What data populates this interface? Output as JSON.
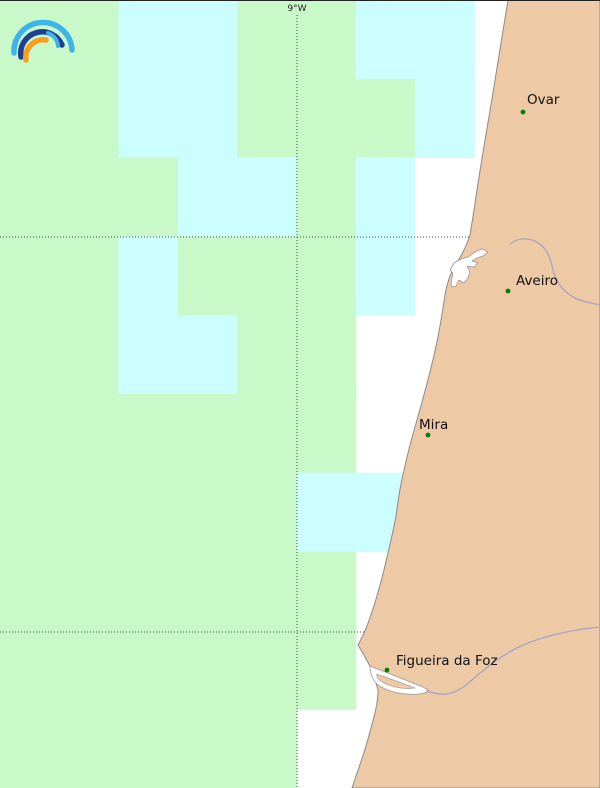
{
  "map": {
    "title": "coastal-forecast-map",
    "colors": {
      "sea": "#ffffff",
      "cell_green": "#c9f8c9",
      "cell_cyan": "#ccfdff",
      "land": "#edc9a6",
      "coast_stroke": "#8c8c8c",
      "water_outline": "#9a9a9a",
      "river": "#a9a3c4",
      "grid_line": "#4d4d4d",
      "city_dot": "#0a7a0a",
      "label_text": "#111111",
      "top_border": "#222222"
    },
    "grid": {
      "cols": 10,
      "rows": 10,
      "cell_w": 59.3,
      "cell_h": 78.8,
      "legend": "G=green cell, C=cyan cell, W=no cell",
      "cells": [
        "GGCCGGCCWW",
        "GGCCGGGCWW",
        "GGGCCGCWWW",
        "GGCGGGCWWW",
        "GGCCGGWWWW",
        "GGGGGGWWWW",
        "GGGGGCCWWW",
        "GGGGGGWWWW",
        "GGGGGGWWWW",
        "GGGGGWWWWW"
      ]
    },
    "graticule": {
      "meridian_label": "9°W",
      "meridian_x": 297,
      "meridian_label_x": 297,
      "meridian_label_y": 11,
      "meridian_y1": 15,
      "meridian_y2": 788,
      "parallels_y": [
        237,
        632
      ]
    },
    "cities": [
      {
        "name": "Ovar",
        "dot": [
          523,
          112
        ],
        "label": [
          527,
          104
        ]
      },
      {
        "name": "Aveiro",
        "dot": [
          508,
          291
        ],
        "label": [
          516,
          285
        ]
      },
      {
        "name": "Mira",
        "dot": [
          428,
          435
        ],
        "label": [
          419,
          429
        ]
      },
      {
        "name": "Figueira da Foz",
        "dot": [
          387,
          670
        ],
        "label": [
          396,
          665
        ]
      }
    ],
    "logo": {
      "name": "rainbow-logo",
      "arc_outer_color": "#3db4ea",
      "arc_middle_color": "#1e3f96",
      "arc_inner_right_color": "#3db4ea",
      "arc_orange_color": "#f8a01d"
    }
  }
}
